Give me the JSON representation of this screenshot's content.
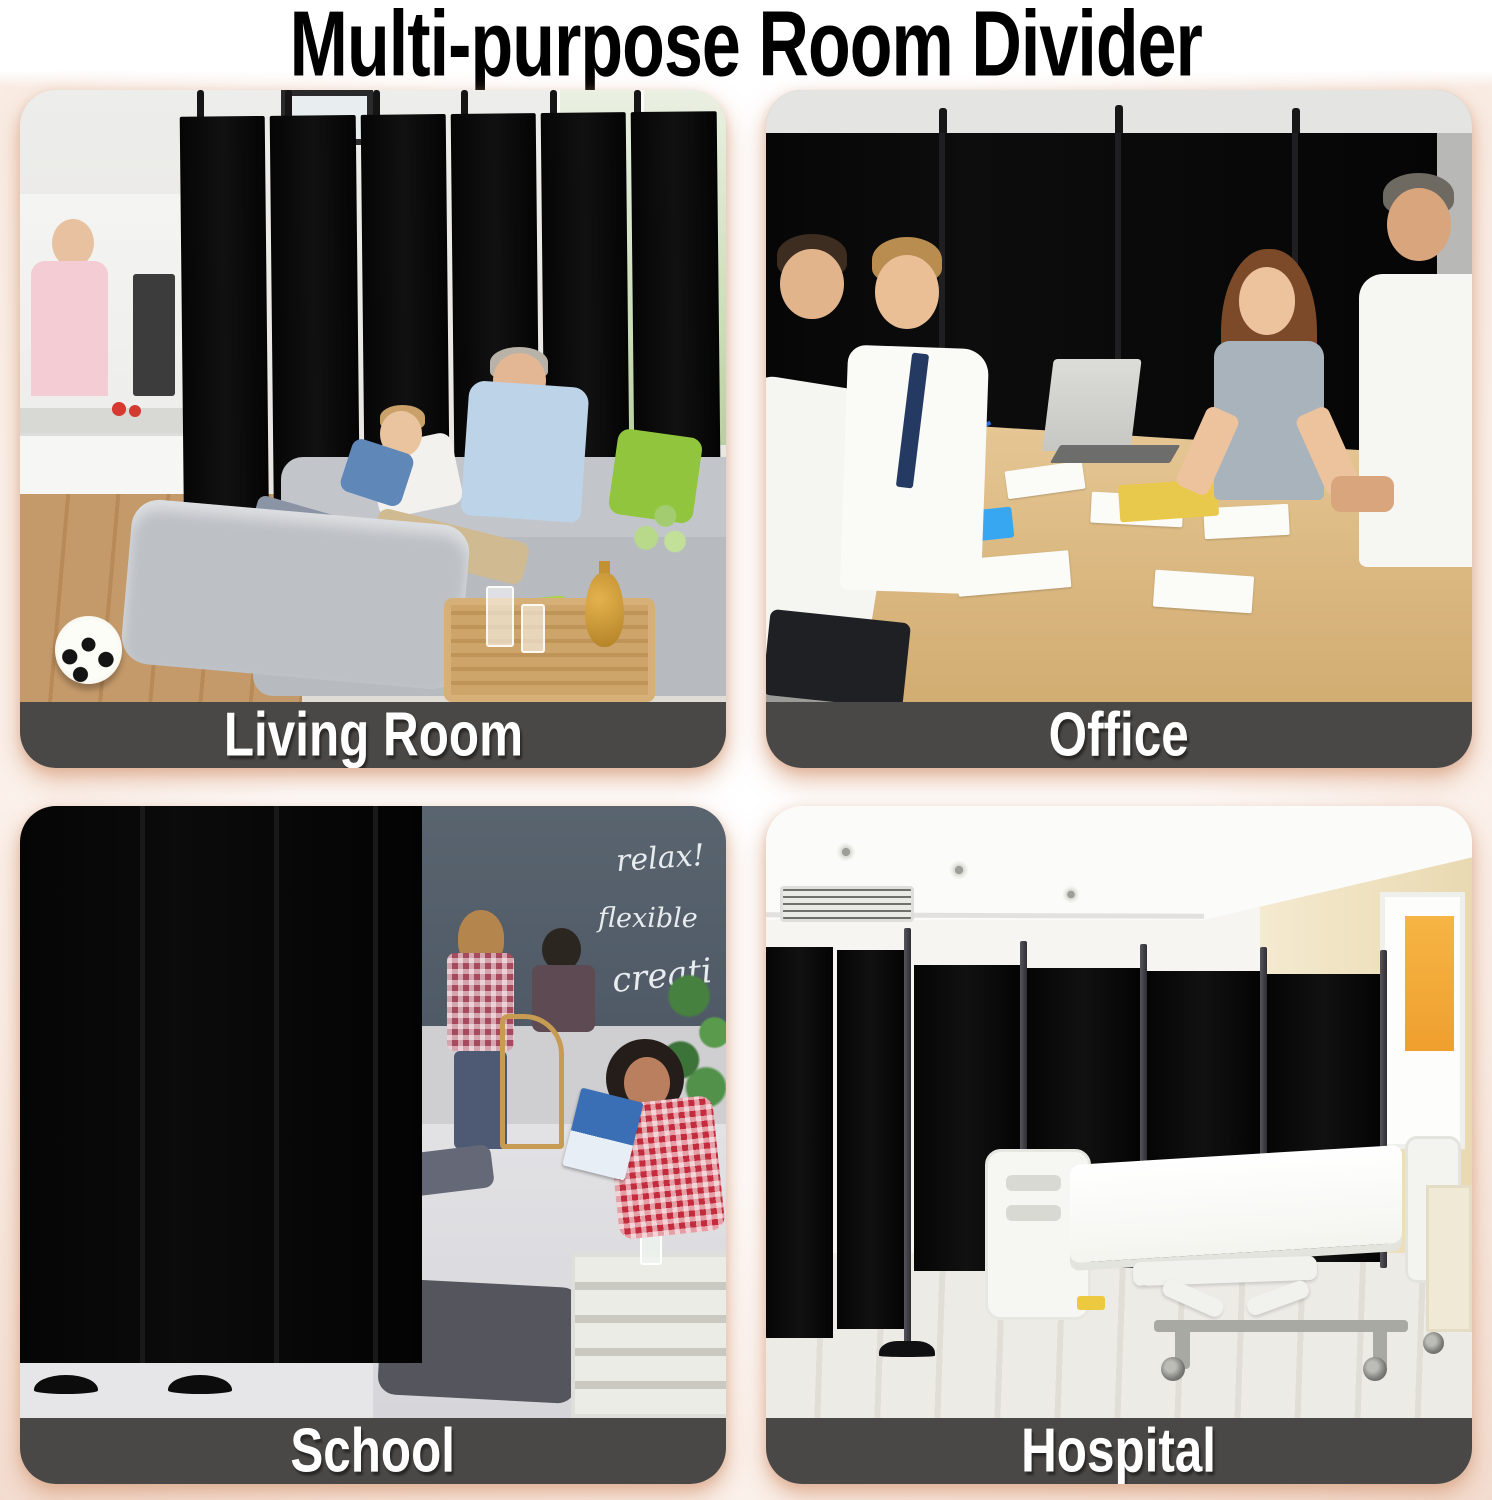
{
  "title": "Multi-purpose Room Divider",
  "cards": [
    {
      "id": "living-room",
      "label": "Living Room"
    },
    {
      "id": "office",
      "label": "Office"
    },
    {
      "id": "school",
      "label": "School"
    },
    {
      "id": "hospital",
      "label": "Hospital"
    }
  ],
  "school_chalkboard_words": [
    "relax!",
    "flexible",
    "creati"
  ],
  "colors": {
    "caption_bg": "#4a4846",
    "caption_text": "#ffffff",
    "divider_black": "#0a0a0a",
    "page_glow": "#f3ddd0",
    "title_color": "#000000"
  }
}
